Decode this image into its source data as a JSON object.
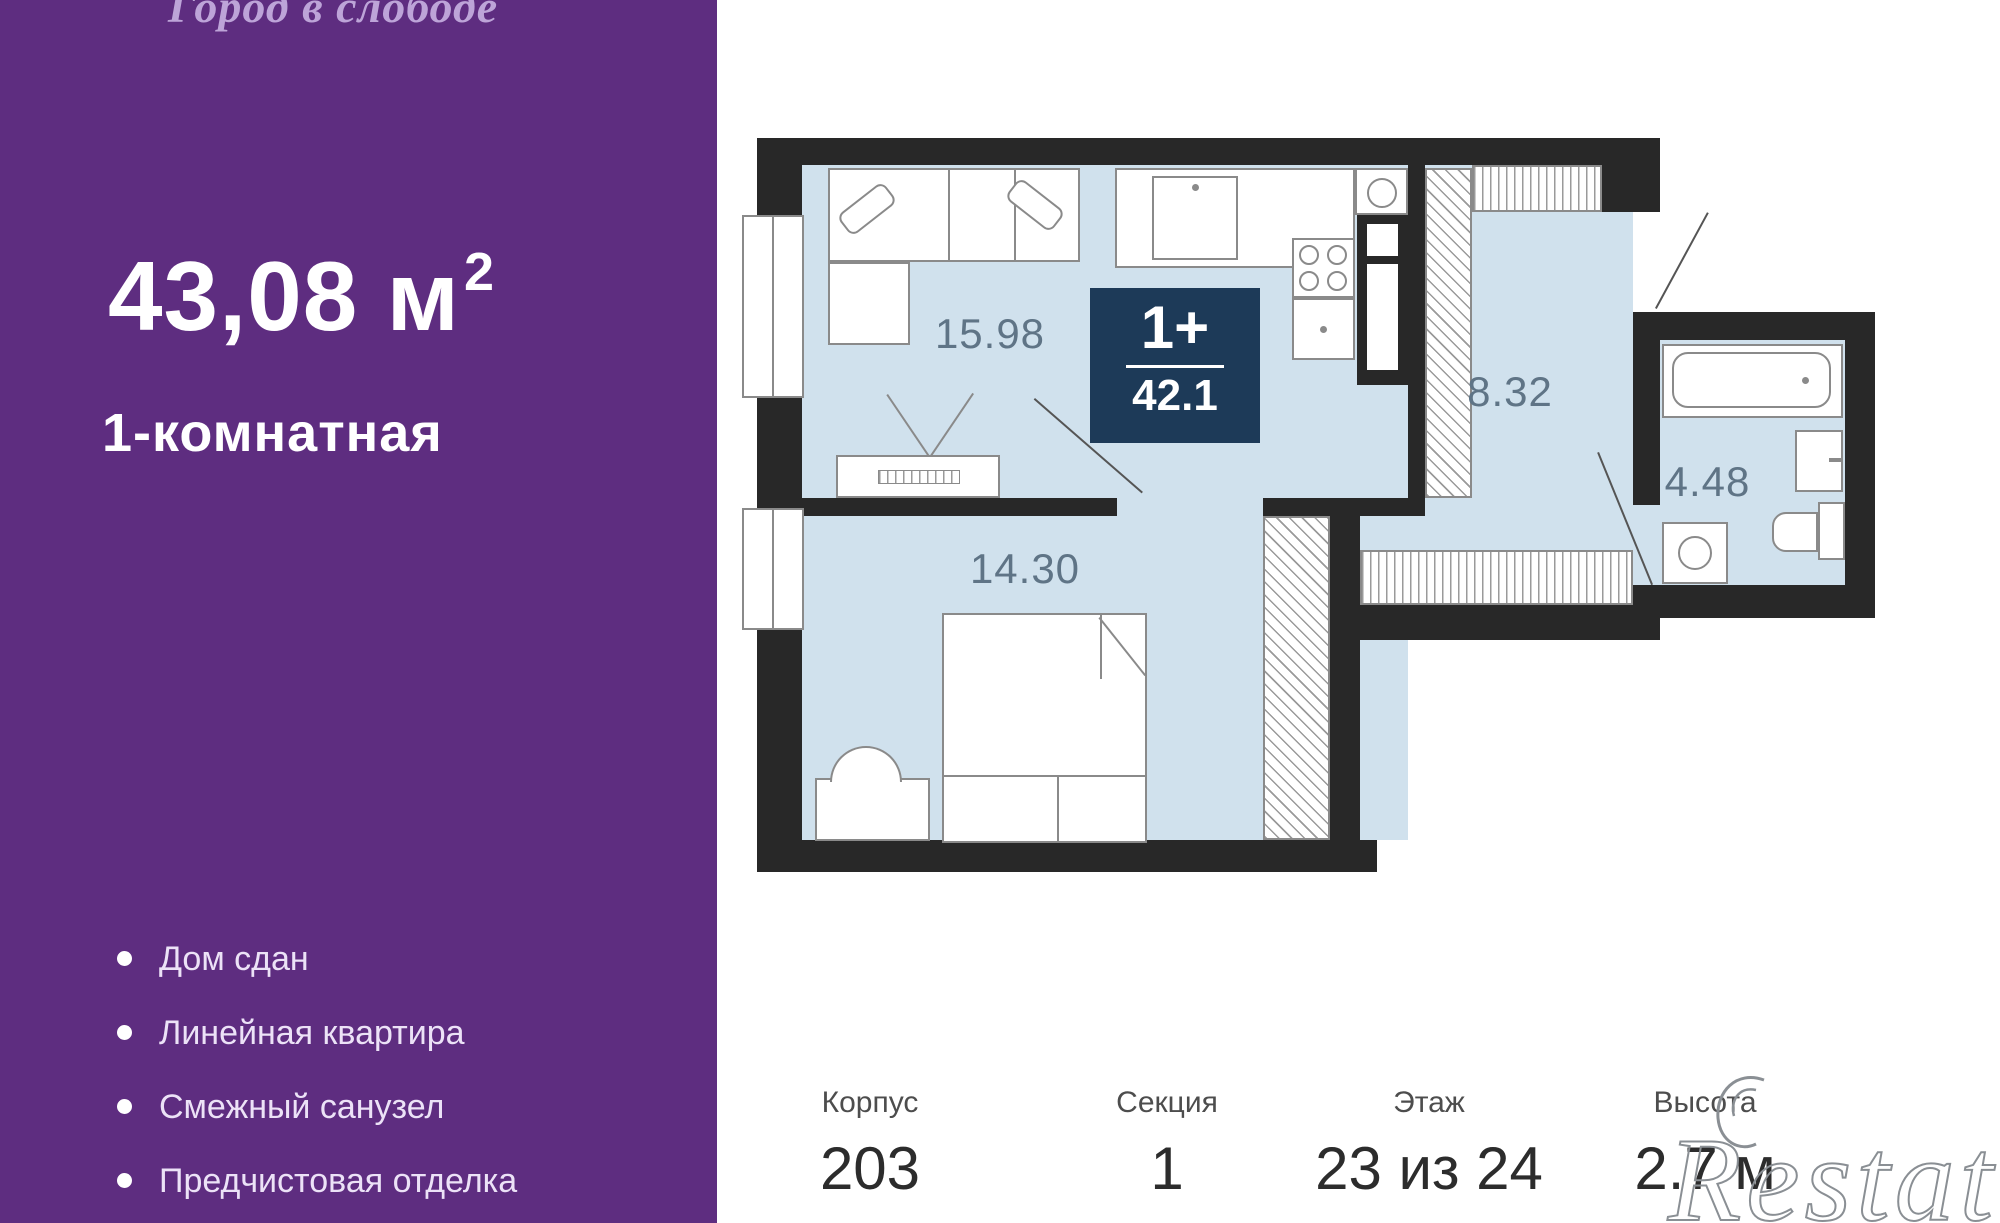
{
  "sidebar": {
    "complex_name": "Город в слободе",
    "area_value": "43,08 м",
    "area_superscript": "2",
    "apartment_type": "1-комнатная",
    "features": [
      "Дом сдан",
      "Линейная квартира",
      "Смежный санузел",
      "Предчистовая отделка"
    ]
  },
  "floor_plan": {
    "badge": {
      "type_label": "1+",
      "total_area": "42.1"
    },
    "room_areas": {
      "living_kitchen": "15.98",
      "bedroom": "14.30",
      "hallway": "8.32",
      "bathroom": "4.48"
    }
  },
  "footer": {
    "stats": [
      {
        "label": "Корпус",
        "value": "203"
      },
      {
        "label": "Секция",
        "value": "1"
      },
      {
        "label": "Этаж",
        "value": "23 из 24"
      },
      {
        "label": "Высота",
        "value": "2.7 м"
      }
    ],
    "watermark": "Restate"
  },
  "colors": {
    "sidebar_bg": "#5e2d80",
    "floor": "#d0e1ed",
    "wall": "#282828",
    "badge_bg": "#1d3a58",
    "room_label": "#5f7486"
  }
}
